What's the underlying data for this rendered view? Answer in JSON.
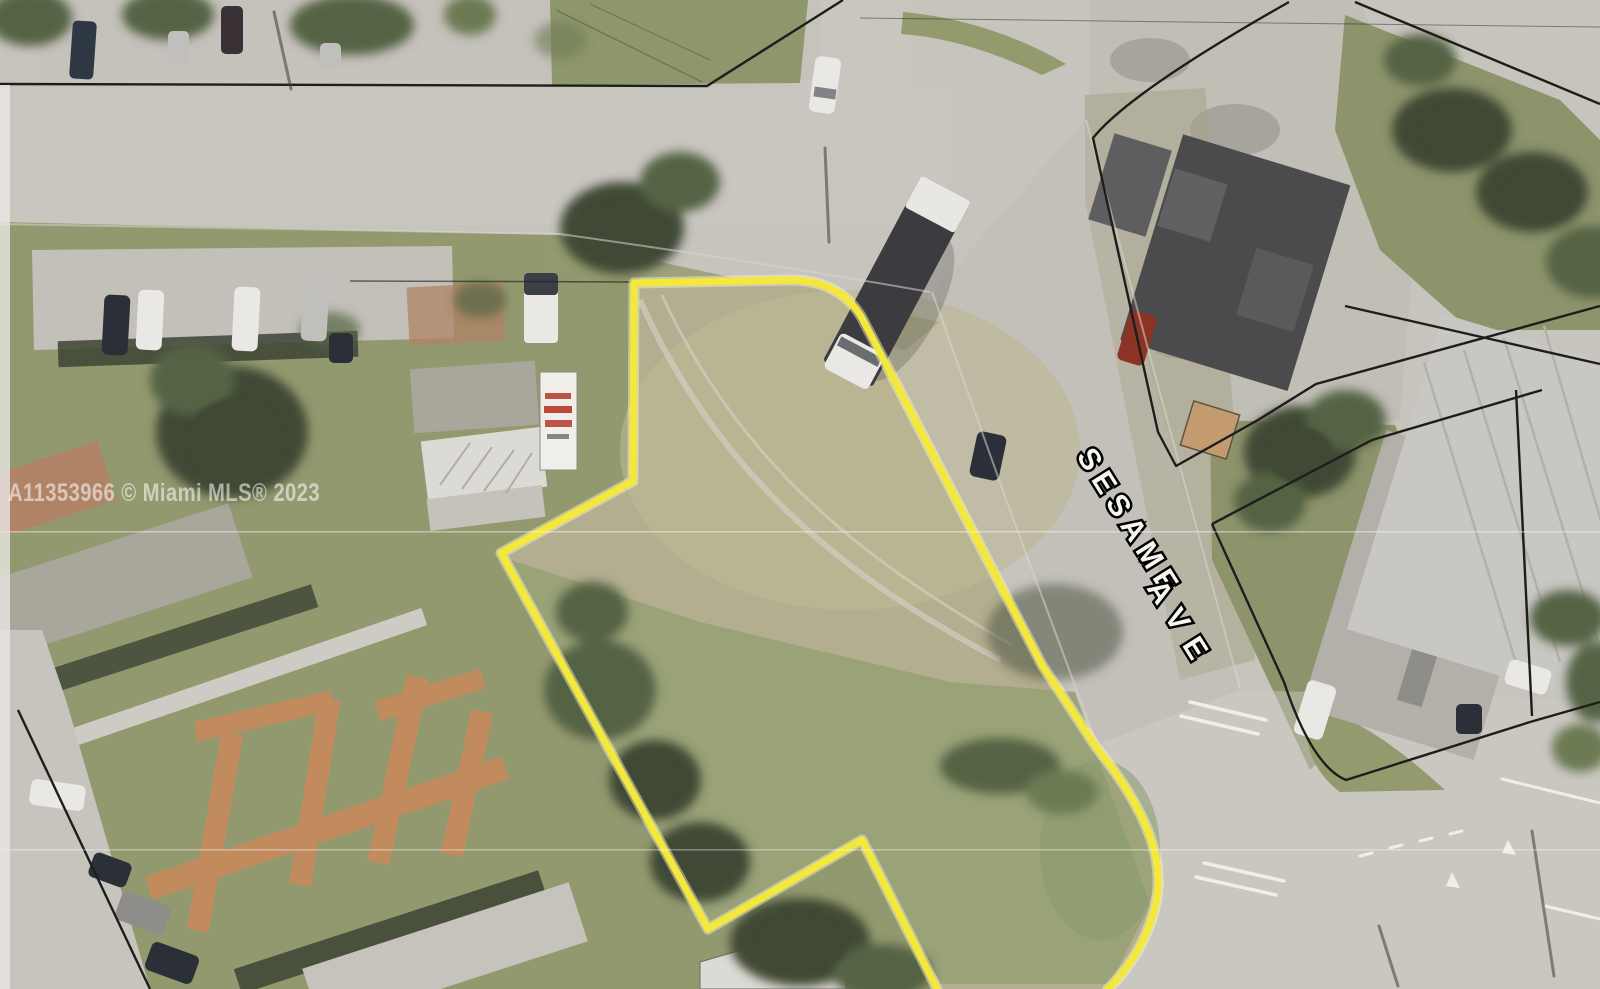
{
  "image": {
    "width": 1600,
    "height": 989,
    "kind": "aerial parcel photo of vacant corner lot"
  },
  "watermark": {
    "text": "A11353966 © Miami MLS® 2023",
    "color": "#ffffff"
  },
  "street_label": {
    "line1": "SESAME",
    "line2": "AVE",
    "fill": "#ffffff",
    "outline": "#000000"
  },
  "property_outline": {
    "color": "#f4e83a",
    "stroke_width": 7,
    "path": "M 937,989 L 862,840 L 708,929 L 501,553 L 633,481 L 634,283 L 790,280 Q 840,280 862,318 L 1042,665 L 1096,747 C 1148,812 1170,866 1152,918 C 1142,948 1127,970 1108,989",
    "fill_path": "M 937,989 L 862,840 L 708,929 L 501,553 L 633,481 L 634,283 L 790,280 Q 840,280 862,318 L 1042,665 L 1096,747 C 1148,812 1170,866 1152,918 C 1142,948 1127,970 1108,989 Z"
  },
  "parcel_lines": {
    "p1": "M 0,84 L 707,86 L 843,0",
    "p2": "M 1355,2 L 1600,104",
    "p3": "M 1289,2 Q 1130,92 1093,138 L 1158,432 L 1176,466 L 1258,420 L 1316,384 L 1600,306",
    "p3b": "M 1345,306 L 1600,364",
    "p4": "M 1212,524 L 1372,440 L 1542,390",
    "p5": "M 1516,390 L 1532,716",
    "p6": "M 1212,524 L 1284,682 Q 1312,766 1346,780 L 1530,722 L 1600,702",
    "p7": "M 18,710 L 150,989",
    "p8": "M 350,281 L 634,282",
    "wire": "M 860,18 L 1600,27",
    "fence1": "M 556,10 L 702,82",
    "fence2": "M 590,4 L 710,60"
  },
  "palette": {
    "road": "#c7c4bd",
    "roadLight": "#cecbc5",
    "roadDark": "#bcb9b2",
    "pave2": "#c3c0b9",
    "grassLeft": "#93996f",
    "grassYard": "#8e966b",
    "grassWedge": "#939a6e",
    "grassEast": "#8d946c",
    "lotTan": "#b3ae8f",
    "lotTanLight": "#bdb795",
    "lotGreen": "#97a175",
    "treeDark": "#3f4a36",
    "treeMid": "#556444",
    "treeSoft": "#6c7a52",
    "hedge": "#3c4435",
    "orangePath": "#c68a5d",
    "roofGray": "#a9a79b",
    "roofBrown": "#b08366",
    "roofWhite": "#dcdad4",
    "roofBottom": "#c6c3bc",
    "warehouseRoof": "#c8c7c3",
    "warehouseSeam": "#b2b1ac",
    "apron": "#b2b0a9",
    "concreteNE": "#c1beb6",
    "darkRoof": "#4b4b4d",
    "shedTan": "#c49b6f",
    "carWhite": "#e9e8e4",
    "carDark": "#2b3038",
    "carSilver": "#c0bfbb",
    "redCar": "#8c3326",
    "stain": "#8d8b84",
    "parcel": "#1d1d1b",
    "outlineYellow": "#f4e83a",
    "white": "#f6f5f1",
    "watermark": "#ffffff",
    "signRed": "#b5372a",
    "shadow": "#3c3c38"
  }
}
